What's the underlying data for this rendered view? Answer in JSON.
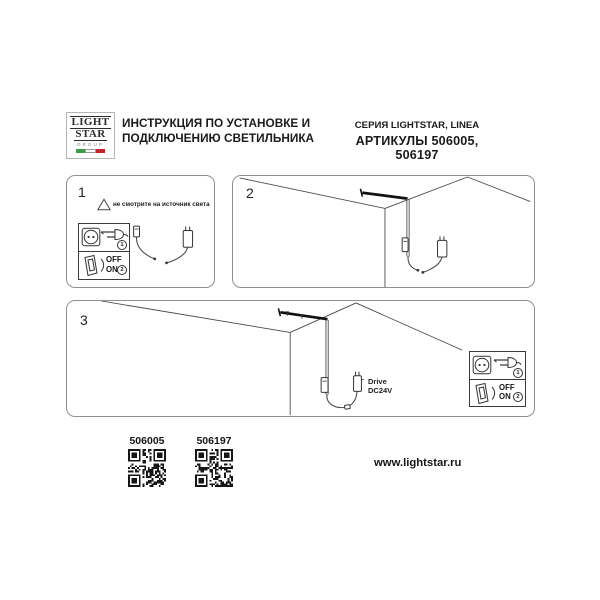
{
  "header": {
    "logo": {
      "light": "LIGHT",
      "star": "STAR",
      "group": "GROUP"
    },
    "title_line1": "ИНСТРУКЦИЯ ПО УСТАНОВКЕ И",
    "title_line2": "ПОДКЛЮЧЕНИЮ СВЕТИЛЬНИКА",
    "series": "СЕРИЯ LIGHTSTAR, LINEA",
    "articles": "АРТИКУЛЫ 506005, 506197"
  },
  "connection_box": {
    "plug_step": "1",
    "switch_step": "2",
    "off": "OFF",
    "on": "ON"
  },
  "panels": {
    "step1": {
      "number": "1",
      "warning": "не смотрите на источник света"
    },
    "step2": {
      "number": "2"
    },
    "step3": {
      "number": "3",
      "drive_line1": "Drive",
      "drive_line2": "DC24V"
    }
  },
  "footer": {
    "article1": "506005",
    "article2": "506197",
    "website": "www.lightstar.ru"
  },
  "colors": {
    "flag_green": "#3f9b47",
    "flag_red": "#c2242e",
    "ink": "#1b1b1b",
    "line_art": "#4a4a4a"
  }
}
